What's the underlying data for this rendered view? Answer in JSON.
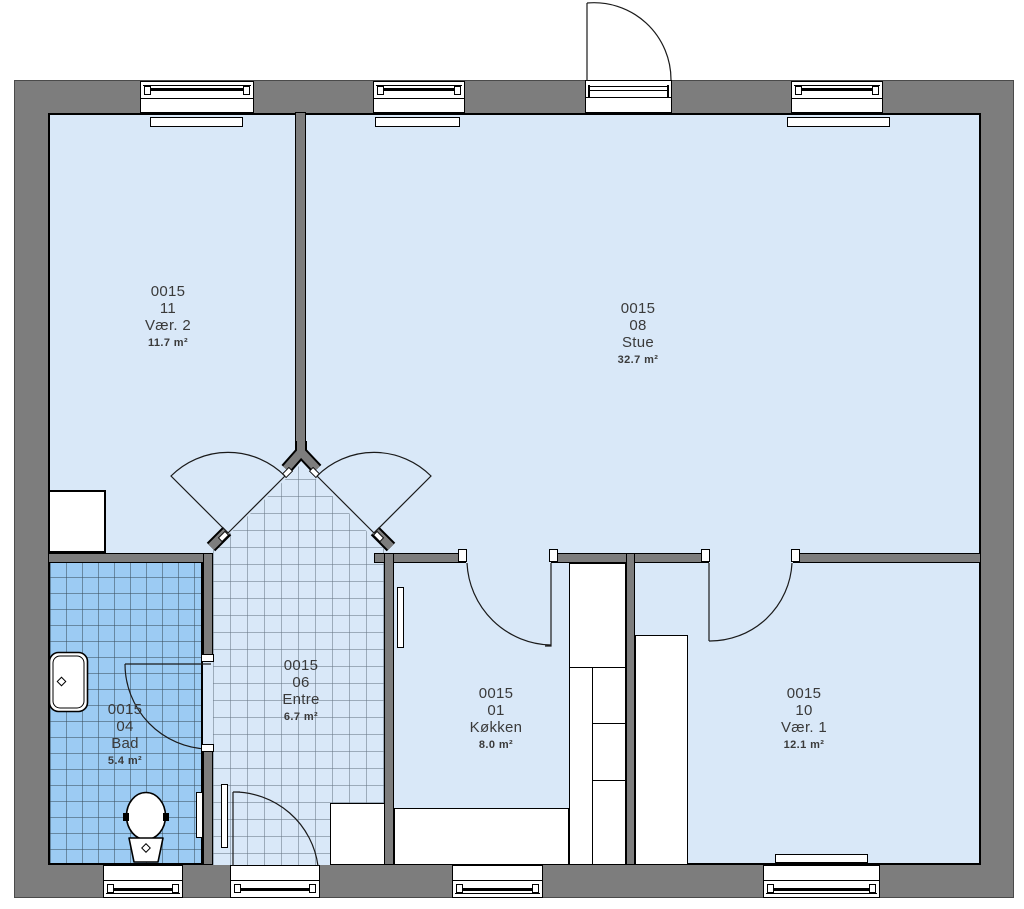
{
  "title": "Floor plan",
  "colors": {
    "wall": "#7d7d7d",
    "room_fill": "#d9e8f8",
    "bath_tile_fill": "#9ccbf3",
    "outline": "#000000",
    "text": "#3a3a3a"
  },
  "rooms": [
    {
      "number": "0015",
      "id": "11",
      "name": "Vær. 2",
      "area": "11.7 m²"
    },
    {
      "number": "0015",
      "id": "08",
      "name": "Stue",
      "area": "32.7 m²"
    },
    {
      "number": "0015",
      "id": "04",
      "name": "Bad",
      "area": "5.4 m²"
    },
    {
      "number": "0015",
      "id": "06",
      "name": "Entre",
      "area": "6.7 m²"
    },
    {
      "number": "0015",
      "id": "01",
      "name": "Køkken",
      "area": "8.0 m²"
    },
    {
      "number": "0015",
      "id": "10",
      "name": "Vær. 1",
      "area": "12.1 m²"
    }
  ],
  "fixtures": {
    "toilet": "toilet-icon",
    "sink": "sink-icon",
    "radiators": "radiator-shape",
    "doors": "door-swing-arc",
    "windows": "window-glazing"
  }
}
